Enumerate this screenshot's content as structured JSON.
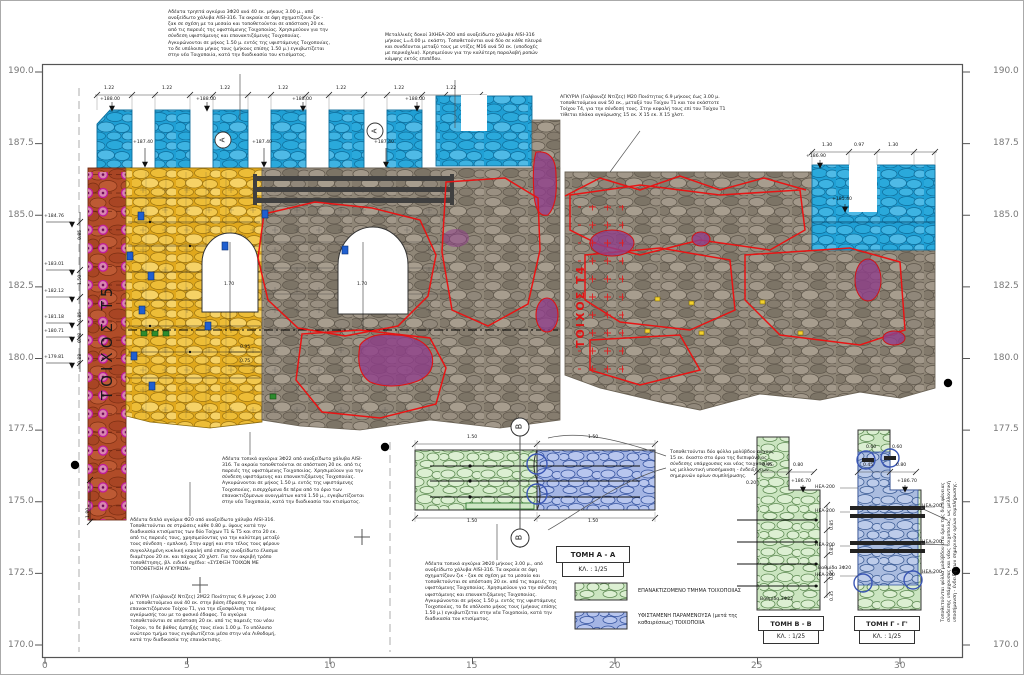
{
  "sheet": {
    "type": "architectural-elevation-drawing",
    "language": "Greek"
  },
  "colors": {
    "new_masonry_cyan": "#2aa7dd",
    "reconstruction_yellow": "#eab62e",
    "wall_section_red": "#b04c28",
    "anchor_magenta": "#c2199e",
    "existing_stone_grey": "#8f8677",
    "marking_red_outline": "#e81414",
    "repair_purple": "#8f3f8a",
    "section_new_green": "#cbe5c0",
    "section_existing_blue": "#a4b5e4"
  },
  "walls": {
    "t5": "ΤΟΙΧΟΣ Τ5",
    "t4": "ΤΟΙΧΟΣ Τ4"
  },
  "markers": {
    "b": "B",
    "a": "A"
  },
  "sections": {
    "a": {
      "title": "ΤΟΜΗ A - A",
      "scale": "ΚΛ. : 1/25"
    },
    "b": {
      "title": "ΤΟΜΗ B - B",
      "scale": "ΚΛ. : 1/25"
    },
    "c": {
      "title": "ΤΟΜΗ Γ - Γ'",
      "scale": "ΚΛ. : 1/25"
    }
  },
  "legend": {
    "new": "ΕΠΑΝΑΚΤΙΖΟΜΕΝΟ ΤΜΗΜΑ ΤΟΙΧΟΠΟΙΙΑΣ",
    "existing": "ΥΦΙΣΤΑΜΕΝΗ ΠΑΡΑΜΕΝΟΥΣΑ (μετά της καθαιρέσεως) ΤΟΙΧΟΠΟΙΙΑ"
  },
  "axis": {
    "left": [
      {
        "name": "axis-left-190",
        "t": "190.0",
        "x": 8,
        "y": 66
      },
      {
        "name": "axis-left-187-5",
        "t": "187.5",
        "x": 8,
        "y": 138
      },
      {
        "name": "axis-left-185",
        "t": "185.0",
        "x": 8,
        "y": 210
      },
      {
        "name": "axis-left-182-5",
        "t": "182.5",
        "x": 8,
        "y": 281
      },
      {
        "name": "axis-left-180",
        "t": "180.0",
        "x": 8,
        "y": 353
      },
      {
        "name": "axis-left-177-5",
        "t": "177.5",
        "x": 8,
        "y": 424
      },
      {
        "name": "axis-left-175",
        "t": "175.0",
        "x": 8,
        "y": 496
      },
      {
        "name": "axis-left-172-5",
        "t": "172.5",
        "x": 8,
        "y": 568
      },
      {
        "name": "axis-left-170",
        "t": "170.0",
        "x": 8,
        "y": 640
      }
    ],
    "right": [
      {
        "name": "axis-right-190",
        "t": "190.0",
        "x": 993,
        "y": 66
      },
      {
        "name": "axis-right-187-5",
        "t": "187.5",
        "x": 993,
        "y": 138
      },
      {
        "name": "axis-right-185",
        "t": "185.0",
        "x": 993,
        "y": 210
      },
      {
        "name": "axis-right-182-5",
        "t": "182.5",
        "x": 993,
        "y": 281
      },
      {
        "name": "axis-right-180",
        "t": "180.0",
        "x": 993,
        "y": 353
      },
      {
        "name": "axis-right-177-5",
        "t": "177.5",
        "x": 993,
        "y": 424
      },
      {
        "name": "axis-right-175",
        "t": "175.0",
        "x": 993,
        "y": 496
      },
      {
        "name": "axis-right-172-5",
        "t": "172.5",
        "x": 993,
        "y": 568
      },
      {
        "name": "axis-right-170",
        "t": "170.0",
        "x": 993,
        "y": 640
      }
    ],
    "bottom": [
      {
        "name": "axis-bottom-0",
        "t": "0",
        "x": 42,
        "y": 661
      },
      {
        "name": "axis-bottom-5",
        "t": "5",
        "x": 184,
        "y": 661
      },
      {
        "name": "axis-bottom-10",
        "t": "10",
        "x": 324,
        "y": 661
      },
      {
        "name": "axis-bottom-15",
        "t": "15",
        "x": 466,
        "y": 661
      },
      {
        "name": "axis-bottom-20",
        "t": "20",
        "x": 609,
        "y": 661
      },
      {
        "name": "axis-bottom-25",
        "t": "25",
        "x": 751,
        "y": 661
      },
      {
        "name": "axis-bottom-30",
        "t": "30",
        "x": 894,
        "y": 661
      }
    ]
  },
  "dims": [
    {
      "name": "dim-merlon",
      "t": "1.22",
      "x": 104,
      "y": 86
    },
    {
      "name": "dim-merlon",
      "t": "1.22",
      "x": 162,
      "y": 86
    },
    {
      "name": "dim-merlon",
      "t": "1.22",
      "x": 220,
      "y": 86
    },
    {
      "name": "dim-merlon",
      "t": "1.22",
      "x": 278,
      "y": 86
    },
    {
      "name": "dim-merlon",
      "t": "1.22",
      "x": 336,
      "y": 86
    },
    {
      "name": "dim-merlon",
      "t": "1.22",
      "x": 394,
      "y": 86
    },
    {
      "name": "dim-merlon",
      "t": "1.22",
      "x": 446,
      "y": 86
    },
    {
      "name": "elev-callout",
      "t": "+188.00",
      "x": 100,
      "y": 97
    },
    {
      "name": "elev-callout",
      "t": "+188.00",
      "x": 196,
      "y": 97
    },
    {
      "name": "elev-callout",
      "t": "+188.00",
      "x": 292,
      "y": 97
    },
    {
      "name": "elev-callout",
      "t": "+188.00",
      "x": 405,
      "y": 97
    },
    {
      "name": "elev-callout",
      "t": "+187.40",
      "x": 133,
      "y": 140
    },
    {
      "name": "elev-callout",
      "t": "+187.40",
      "x": 252,
      "y": 140
    },
    {
      "name": "elev-callout",
      "t": "+187.40",
      "x": 374,
      "y": 140
    },
    {
      "name": "dim-merlon",
      "t": "1.30",
      "x": 822,
      "y": 143
    },
    {
      "name": "dim-merlon",
      "t": "0.97",
      "x": 854,
      "y": 143
    },
    {
      "name": "dim-merlon",
      "t": "1.30",
      "x": 888,
      "y": 143
    },
    {
      "name": "elev-callout",
      "t": "+186.90",
      "x": 806,
      "y": 154
    },
    {
      "name": "elev-callout",
      "t": "+185.40",
      "x": 832,
      "y": 197
    },
    {
      "name": "elev-callout",
      "t": "+184.76",
      "x": 44,
      "y": 214
    },
    {
      "name": "elev-callout",
      "t": "+183.01",
      "x": 44,
      "y": 262
    },
    {
      "name": "elev-callout",
      "t": "+182.12",
      "x": 44,
      "y": 289
    },
    {
      "name": "elev-callout",
      "t": "+181.18",
      "x": 44,
      "y": 315
    },
    {
      "name": "elev-callout",
      "t": "+180.71",
      "x": 44,
      "y": 329
    },
    {
      "name": "elev-callout",
      "t": "+179.81",
      "x": 44,
      "y": 355
    },
    {
      "name": "dim-chain",
      "t": "0.85",
      "x": 78,
      "y": 240,
      "r": -90
    },
    {
      "name": "dim-chain",
      "t": "1.50",
      "x": 78,
      "y": 285,
      "r": -90
    },
    {
      "name": "dim-chain",
      "t": "0.85",
      "x": 78,
      "y": 322,
      "r": -90
    },
    {
      "name": "dim-chain",
      "t": "0.48",
      "x": 78,
      "y": 343,
      "r": -90
    },
    {
      "name": "dim-chain",
      "t": "0.88",
      "x": 78,
      "y": 364,
      "r": -90
    },
    {
      "name": "dim-chain",
      "t": "1.80",
      "x": 86,
      "y": 518,
      "r": -90
    },
    {
      "name": "dim-arch",
      "t": "1.70",
      "x": 224,
      "y": 282
    },
    {
      "name": "dim-arch",
      "t": "1.70",
      "x": 357,
      "y": 282
    },
    {
      "name": "dim",
      "t": "0.95",
      "x": 240,
      "y": 345
    },
    {
      "name": "dim",
      "t": "0.75",
      "x": 240,
      "y": 359
    },
    {
      "name": "dim-plan",
      "t": "1.50",
      "x": 467,
      "y": 435
    },
    {
      "name": "dim-plan",
      "t": "1.50",
      "x": 588,
      "y": 435
    },
    {
      "name": "dim-plan",
      "t": "1.50",
      "x": 467,
      "y": 519
    },
    {
      "name": "dim-plan",
      "t": "1.50",
      "x": 588,
      "y": 519
    },
    {
      "name": "dim-section-b",
      "t": "0.45",
      "x": 762,
      "y": 463
    },
    {
      "name": "dim-section-b",
      "t": "0.80",
      "x": 793,
      "y": 463
    },
    {
      "name": "dim-section-b",
      "t": "0.20",
      "x": 746,
      "y": 481
    },
    {
      "name": "elev-callout",
      "t": "+186.70",
      "x": 791,
      "y": 479
    },
    {
      "name": "dim-chain",
      "t": "0.85",
      "x": 830,
      "y": 530,
      "r": -90
    },
    {
      "name": "dim-chain",
      "t": "0.85",
      "x": 830,
      "y": 555,
      "r": -90
    },
    {
      "name": "dim-chain",
      "t": "0.85",
      "x": 830,
      "y": 580,
      "r": -90
    },
    {
      "name": "dim-chain",
      "t": "0.35",
      "x": 830,
      "y": 601,
      "r": -90
    },
    {
      "name": "dim-section-c",
      "t": "0.45",
      "x": 863,
      "y": 463
    },
    {
      "name": "dim-section-c",
      "t": "0.80",
      "x": 896,
      "y": 463
    },
    {
      "name": "elev-callout",
      "t": "+186.70",
      "x": 897,
      "y": 479
    },
    {
      "name": "dim-section-c",
      "t": "0.60",
      "x": 866,
      "y": 445
    },
    {
      "name": "dim-section-c",
      "t": "0.60",
      "x": 892,
      "y": 445
    },
    {
      "name": "hea-label",
      "t": "HEA-200",
      "x": 815,
      "y": 485
    },
    {
      "name": "hea-label",
      "t": "HEA-200",
      "x": 815,
      "y": 509
    },
    {
      "name": "hea-label",
      "t": "HEA-200",
      "x": 815,
      "y": 543
    },
    {
      "name": "hea-label",
      "t": "HEA-200",
      "x": 815,
      "y": 573
    },
    {
      "name": "hea-label",
      "t": "HEA-200",
      "x": 922,
      "y": 504
    },
    {
      "name": "hea-label",
      "t": "HEA-200",
      "x": 922,
      "y": 540
    },
    {
      "name": "hea-label",
      "t": "HEA-200",
      "x": 922,
      "y": 570
    },
    {
      "name": "step-label",
      "t": "Βαθμίδα 3Φ22",
      "x": 760,
      "y": 597
    },
    {
      "name": "step-label",
      "t": "Βαθμίδα 3Φ20",
      "x": 818,
      "y": 566
    }
  ],
  "notes": [
    {
      "name": "note-anchors-3f20-top",
      "x": 168,
      "y": 10,
      "w": 162,
      "t": "Αδέατα τρηπτά αγκύρια 3Φ20 ανά 40 εκ. μήκους 3.00 μ., από ανοξείδωτο χάλυβα AISI-316. Τα ακραία σε όψη σχηματίζουν ζικ - ζακ σε σχέση με τα μεσαία και τοποθετούνται σε απόσταση 20 εκ. από τις παρειές της υφιστάμενης Τοιχοποιίας. Χρησιμεύουν για την σύνδεση υφιστάμενης και επανακτιζόμενης Τοιχοποιίας. Αγκυρώνονται σε μήκος 1.50 μ. εντός της υφιστάμενης Τοιχοποιίας, το δε υπόλοιπο μήκος τους (μήκους επίσης 1.50 μ.) εγκιβωτίζεται στην νέα Τοιχοποιία, κατά την διαδικασία του κτισίματος."
    },
    {
      "name": "note-steel-beams",
      "x": 385,
      "y": 33,
      "w": 158,
      "t": "Μεταλλικές δοκοί 3ΧΗΕΑ-200 από ανοξείδωτο χάλυβα AISI-316 μήκους L=4.00 μ. εκάστη. Τοποθετούνται ανά δύο σε κάθε πλευρά και συνδέονται μεταξύ τους με ντίζες Μ16 ανά 50 εκ. (υποδοχές με περικόχλια). Χρησιμεύουν για την καλύτερη παραλαβή ροπών κάμψης εκτός επιπέδου."
    },
    {
      "name": "note-anchors-m20",
      "x": 560,
      "y": 95,
      "w": 172,
      "t": "ΑΓΚΥΡΙΑ (Γαλβανιζέ Ντίζες) Μ20 Ποιότητας 6.9 μήκους έως 3.00 μ. τοποθετούμενα ανά 50 εκ., μεταξύ του Τοίχου Τ1 και του εκάστοτε Τοίχου Τ4, για την σύνδεσή τους. Στην κεφαλή τους επί του Τοίχου Τ1 τίθεται πλάκα αγκύρωσης 15 εκ. Χ 15 εκ. Χ 15 χλστ."
    },
    {
      "name": "note-anchors-3f22",
      "x": 222,
      "y": 457,
      "w": 150,
      "t": "Αδέατα τοπικά αγκύρια 3Φ22 από ανοξείδωτο χάλυβα AISI-316. Τα ακραία τοποθετούνται σε απόσταση 20 εκ. από τις παρειές της υφιστάμενης Τοιχοποιίας. Χρησιμεύουν για την σύνδεση υφιστάμενης και επανακτιζόμενης Τοιχοποιίας. Αγκυρώνονται σε μήκος 1.50 μ. εντός της υφιστάμενης Τοιχοποιίας, εισερχόμενα δε πέρα από το όριο των επανακτιζόμενων ανοιγμάτων κατά 1.50 μ., εγκιβωτίζονται στην νέα Τοιχοποιία, κατά την διαδικασία του κτισίματος."
    },
    {
      "name": "note-double-anchors-f20",
      "x": 130,
      "y": 518,
      "w": 150,
      "t": "Αδέατα διπλά αγκύρια Φ20 από ανοξείδωτο χάλυβα AISI-316. Τοποθετούνται σε στρώσεις κάθε 0.80 μ. ύψους κατά την διαδικασία κτισίματος των δύο Τοίχων Τ1 & Τ5 και στα 20 εκ. από τις παρειές τους, χρησιμεύοντας για την καλύτερη μεταξύ τους σύνδεση - εμπλοκή. Στην αρχή και στο τέλος τους φέρουν συγκολλημένη κυκλική κεφαλή από επίσης ανοξείδωτο έλασμα διαμέτρου 20 εκ. και πάχους 20 χλστ. Για τον ακριβή τρόπο τοποθέτησης, βλ. ειδικό σχέδιο: «ΣΥΣΦΙΞΗ ΤΟΙΧΩΝ ΜΕ ΤΟΠΟΘΕΤΗΣΗ ΑΓΚΥΡΙΩΝ»"
    },
    {
      "name": "note-anchors-2m22",
      "x": 130,
      "y": 595,
      "w": 152,
      "t": "ΑΓΚΥΡΙΑ (Γαλβανιζέ Ντίζες) 2Μ22 Ποιότητας 6.9 μήκους 2.00 μ. τοποθετούμενα ανά 40 εκ. στην βάση έδρασης του επανακτιζόμενου Τοίχου Τ1, για την εξασφάλιση της πλήρους αγκύρωσής του με το φυσικό έδαφος. Τα αγκύρια τοποθετούνται σε απόσταση 20 εκ. από τις παρειές του νέου Τοίχου, το δε βάθος έμπηξής τους είναι 1.00 μ. Το υπόλοιπο ανώτερο τμήμα τους εγκιβωτίζεται μέσα στην νέα Λιθοδομή, κατά την διαδικασία της επανάκτισης."
    },
    {
      "name": "note-anchors-3f20-bottom",
      "x": 425,
      "y": 562,
      "w": 142,
      "t": "Αδέατα τοπικά αγκύρια 3Φ20 μήκους 3.00 μ., από ανοξείδωτο χάλυβα AISI-316. Τα ακραία σε όψη σχηματίζουν ζικ - ζακ σε σχέση με τα μεσαία και τοποθετούνται σε απόσταση 20 εκ. από τις παρειές της υφιστάμενης Τοιχοποιίας. Χρησιμεύουν για την σύνδεση υφιστάμενης και επανακτιζόμενης Τοιχοποιίας. Αγκυρώνονται σε μήκος 1.50 μ. εντός της υφιστάμενης Τοιχοποιίας, το δε υπόλοιπο μήκος τους (μήκους επίσης 1.50 μ.) εγκιβωτίζεται στην νέα Τοιχοποιία, κατά την διαδικασία του κτισίματος."
    },
    {
      "name": "note-lead-sheets",
      "x": 670,
      "y": 450,
      "w": 106,
      "t": "Τοποθετούνται δύο φύλλα μολύβδου πάχους 15 εκ. έκαστο στα όρια της διεπιφάνειας σύνδεσης υπάρχουσας και νέας τοιχοποιίας, ως μελλοντική υποσήμανση - ένδειξη των σημερινών ορίων συμπλήρωσης."
    },
    {
      "name": "note-lead-sheets-rotated",
      "x": 941,
      "y": 622,
      "w": 150,
      "r": -90,
      "t": "Τοποθετούνται φύλλα μολύβδου στα όρια της διεπιφάνειας σύνδεσης υπάρχουσας και νέας τοιχοποιίας, ως μελλοντική υποσήμανση - ένδειξη των σημερινών ορίων συμπλήρωσης."
    }
  ]
}
